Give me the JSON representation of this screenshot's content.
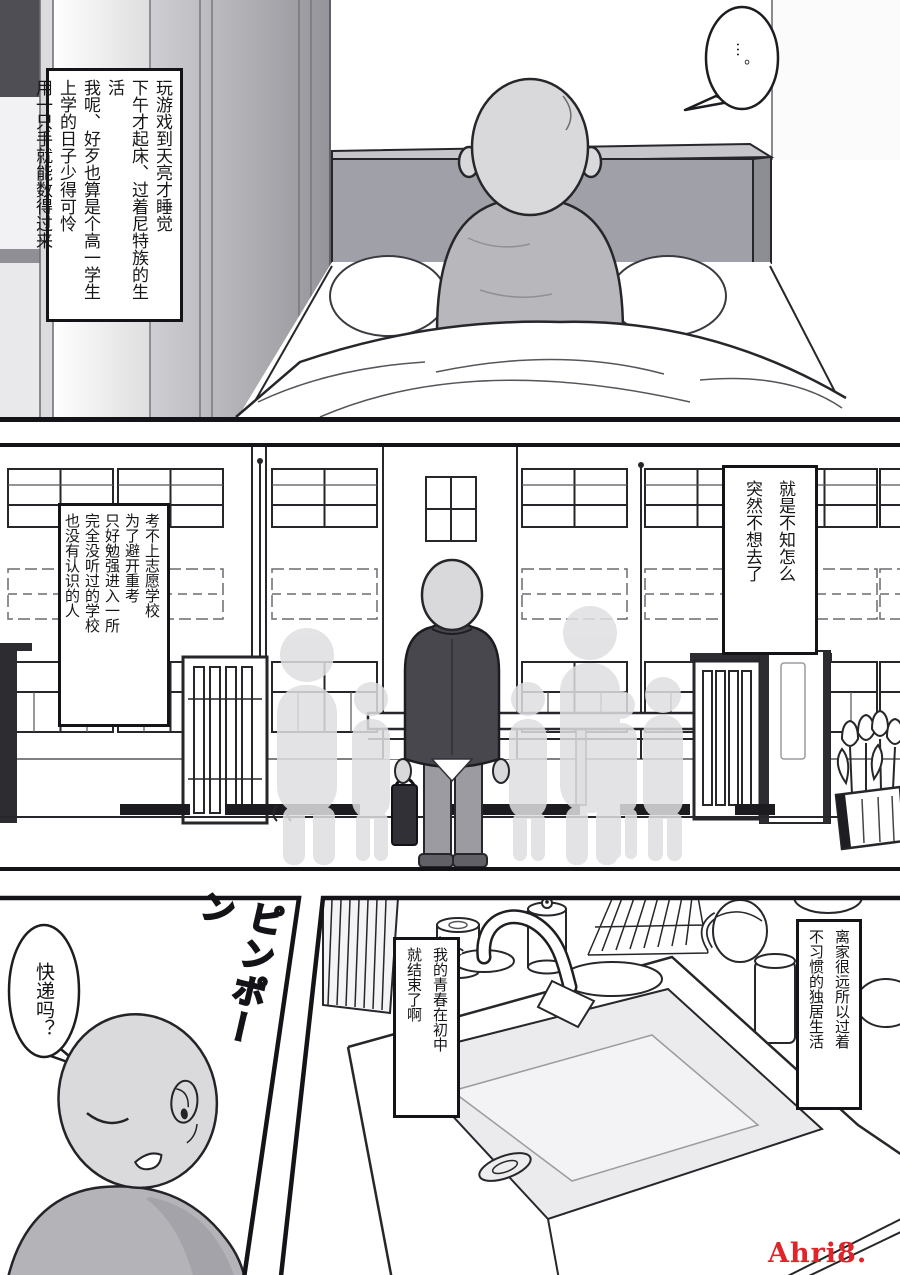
{
  "page": {
    "watermark": "Ahri8. com",
    "watermark_color": "#e0252a",
    "ink_color": "#141418",
    "background_color": "#ffffff"
  },
  "panel1": {
    "narration": "玩游戏到天亮才睡觉\n下午才起床、过着尼特族的生活\n我呢、好歹也算是个高一学生\n上学的日子少得可怜\n用一只手就能数得过来",
    "bubble": "…。"
  },
  "panel2": {
    "narration_left": "考不上志愿学校\n为了避开重考\n只好勉强进入一所\n完全没听过的学校\n也没有认识的人",
    "narration_right": "就是不知怎么\n突然不想去了"
  },
  "panel3": {
    "sfx": "ピンポーン",
    "bubble": "快递吗？",
    "narration_mid": "我的青春在初中\n就结束了啊",
    "narration_right": "离家很远所以过着\n不习惯的独居生活"
  }
}
